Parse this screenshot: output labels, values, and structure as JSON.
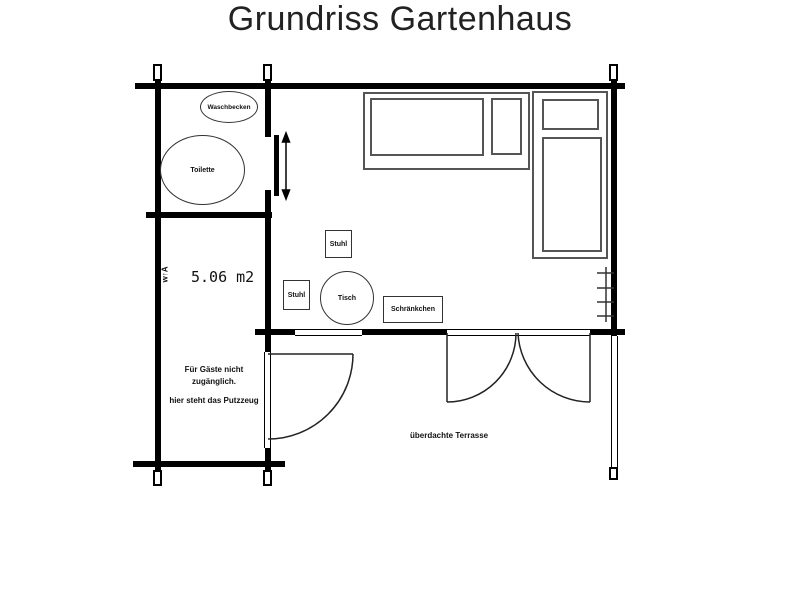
{
  "title": "Grundriss Gartenhaus",
  "bathroom": {
    "sink_label": "Waschbecken",
    "toilet_label": "Toilette"
  },
  "storage_room": {
    "area": "5.06 m2",
    "wall_marker": "w↑A",
    "note_line1": "Für Gäste nicht",
    "note_line2": "zugänglich.",
    "note_line3": "hier steht das Putzzeug"
  },
  "main_room": {
    "chair1_label": "Stuhl",
    "chair2_label": "Stuhl",
    "table_label": "Tisch",
    "cabinet_label": "Schränkchen"
  },
  "terrace": {
    "label": "überdachte Terrasse"
  },
  "colors": {
    "wall": "#000000",
    "furniture_outline": "#555555",
    "fixture_outline": "#333333",
    "text": "#111111",
    "background": "#ffffff"
  }
}
